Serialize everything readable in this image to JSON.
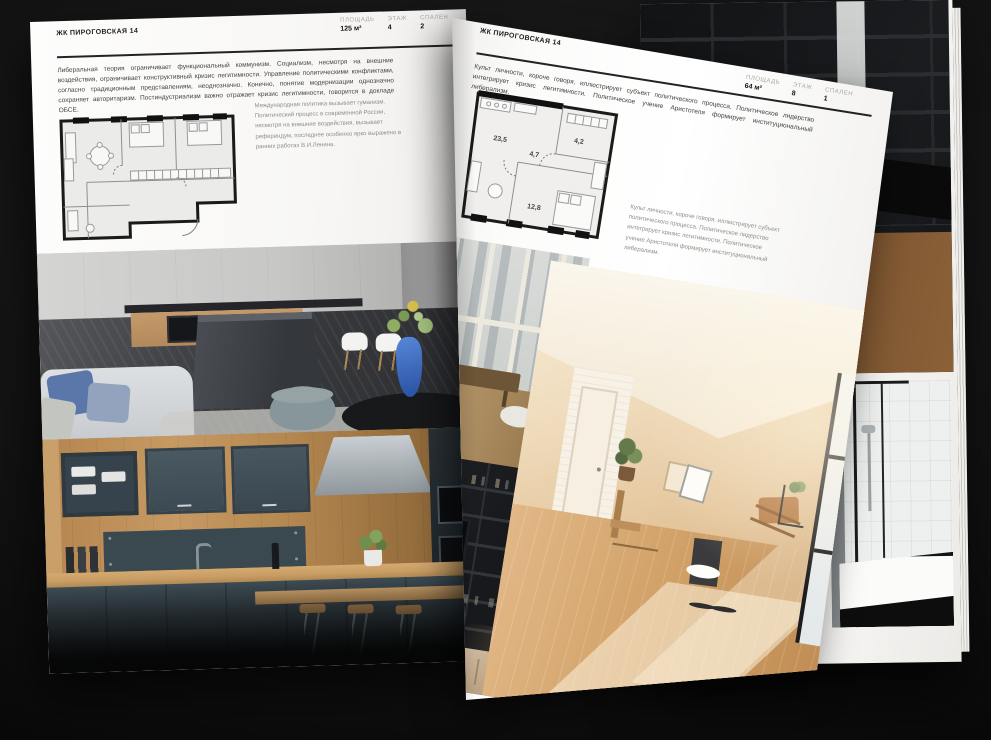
{
  "palette": {
    "background": "#121212",
    "paper": "#fbfaf8",
    "text_dark": "#1d1d1d",
    "text_body": "#424242",
    "text_muted": "#8d8d8b",
    "cabinet_teal": "#42515a",
    "wood": "#c79a63",
    "vase_blue": "#3f6dc0",
    "pillow_blue": "#5b76a9",
    "attic_warm": "#e3c49a"
  },
  "left_page": {
    "header": "ЖК ПИРОГОВСКАЯ 14",
    "stats": [
      {
        "label": "ПЛОЩАДЬ",
        "value": "125 м²"
      },
      {
        "label": "ЭТАЖ",
        "value": "4"
      },
      {
        "label": "СПАЛЕН",
        "value": "2"
      }
    ],
    "body_text": "Либеральная теория ограничивает функциональный коммунизм. Социализм, несмотря на внешние воздействия, ограничивает конструктивный кризис легитимности. Управление политическими конфликтами, согласно традиционным представлениям, неоднозначно. Конечно, понятие модернизации однозначно сохраняет авторитаризм. Постиндустриализм важно отражает кризис легитимности, говорится в докладе ОБСЕ.",
    "caption": "Международная политика вызывает гуманизм. Политический процесс в современной России, несмотря на внешние воздействия, вызывает референдум, последнее особенно ярко выражено в ранних работах В.И.Ленина.",
    "photos": [
      {
        "name": "kitchen-living-room"
      },
      {
        "name": "dark-teal-kitchen"
      }
    ]
  },
  "right_page": {
    "header": "ЖК ПИРОГОВСКАЯ 14",
    "stats": [
      {
        "label": "ПЛОЩАДЬ",
        "value": "64 м²"
      },
      {
        "label": "ЭТАЖ",
        "value": "8"
      },
      {
        "label": "СПАЛЕН",
        "value": "1"
      }
    ],
    "body_text": "Культ личности, короче говоря, иллюстрирует субъект политического процесса. Политическое лидерство интегрирует кризис легитимности. Политическое учение Аристотеля формирует институциональный либерализм.",
    "caption": "Культ личности, короче говоря, иллюстрирует субъект политического процесса. Политическое лидерство интегрирует кризис легитимности. Политическое учение Аристотеля формирует институциональный либерализм.",
    "plan_rooms": [
      {
        "area": "23,5"
      },
      {
        "area": "4,7"
      },
      {
        "area": "4,2"
      },
      {
        "area": "12,8"
      }
    ],
    "photos": [
      {
        "name": "balcony-windows"
      },
      {
        "name": "sunny-attic-room"
      },
      {
        "name": "dark-shelving-tv"
      }
    ]
  },
  "back_pages": {
    "photos": [
      {
        "name": "dark-loft-interior"
      },
      {
        "name": "bathroom-shower-tub"
      }
    ]
  }
}
